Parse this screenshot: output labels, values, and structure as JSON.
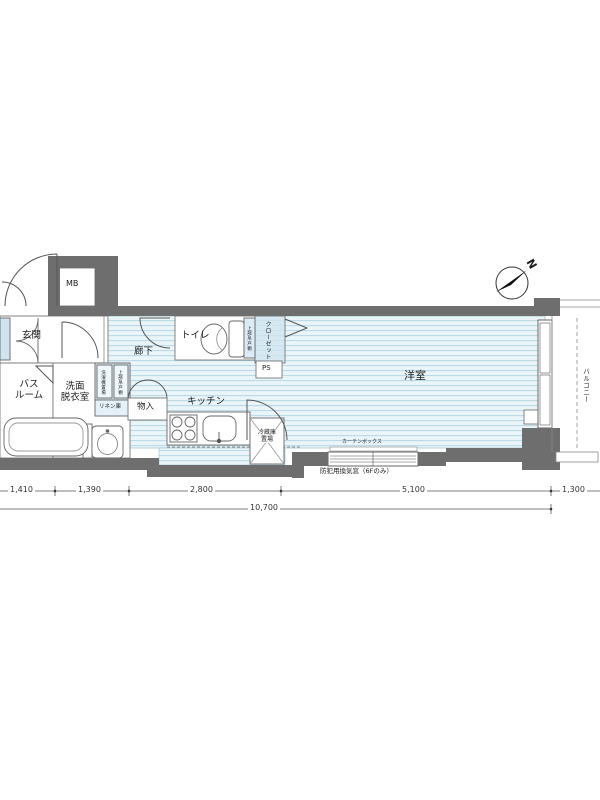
{
  "compass": {
    "north_label": "N"
  },
  "rooms": {
    "meter_box": "MB",
    "entrance": "玄関",
    "bathroom": "バス\nルーム",
    "washroom": "洗面\n脱衣室",
    "hallway": "廊下",
    "toilet": "トイレ",
    "closet": "クローゼット",
    "storage": "物入",
    "kitchen": "キッチン",
    "western_room": "洋室",
    "balcony": "バルコニー",
    "pipe_space": "PS"
  },
  "fixtures": {
    "washer_space": "洗濯機置場",
    "washer_upper_shelf": "上部吊戸棚",
    "linen_storage": "リネン庫",
    "toilet_upper_shelf": "上部吊戸棚",
    "fridge_space": "冷蔵庫\n置場",
    "curtain_box": "カーテンボックス",
    "security_window": "防犯用換気窓（6Fのみ）"
  },
  "dimensions": {
    "width_segments": [
      "1,410",
      "1,390",
      "2,800",
      "5,100",
      "1,300"
    ],
    "total_width": "10,700"
  },
  "colors": {
    "wall": "#6e6e6e",
    "floor_base": "#eaf5f9",
    "floor_stripe": "#b7d8e4",
    "fixture_fill": "#d8eaf4"
  }
}
